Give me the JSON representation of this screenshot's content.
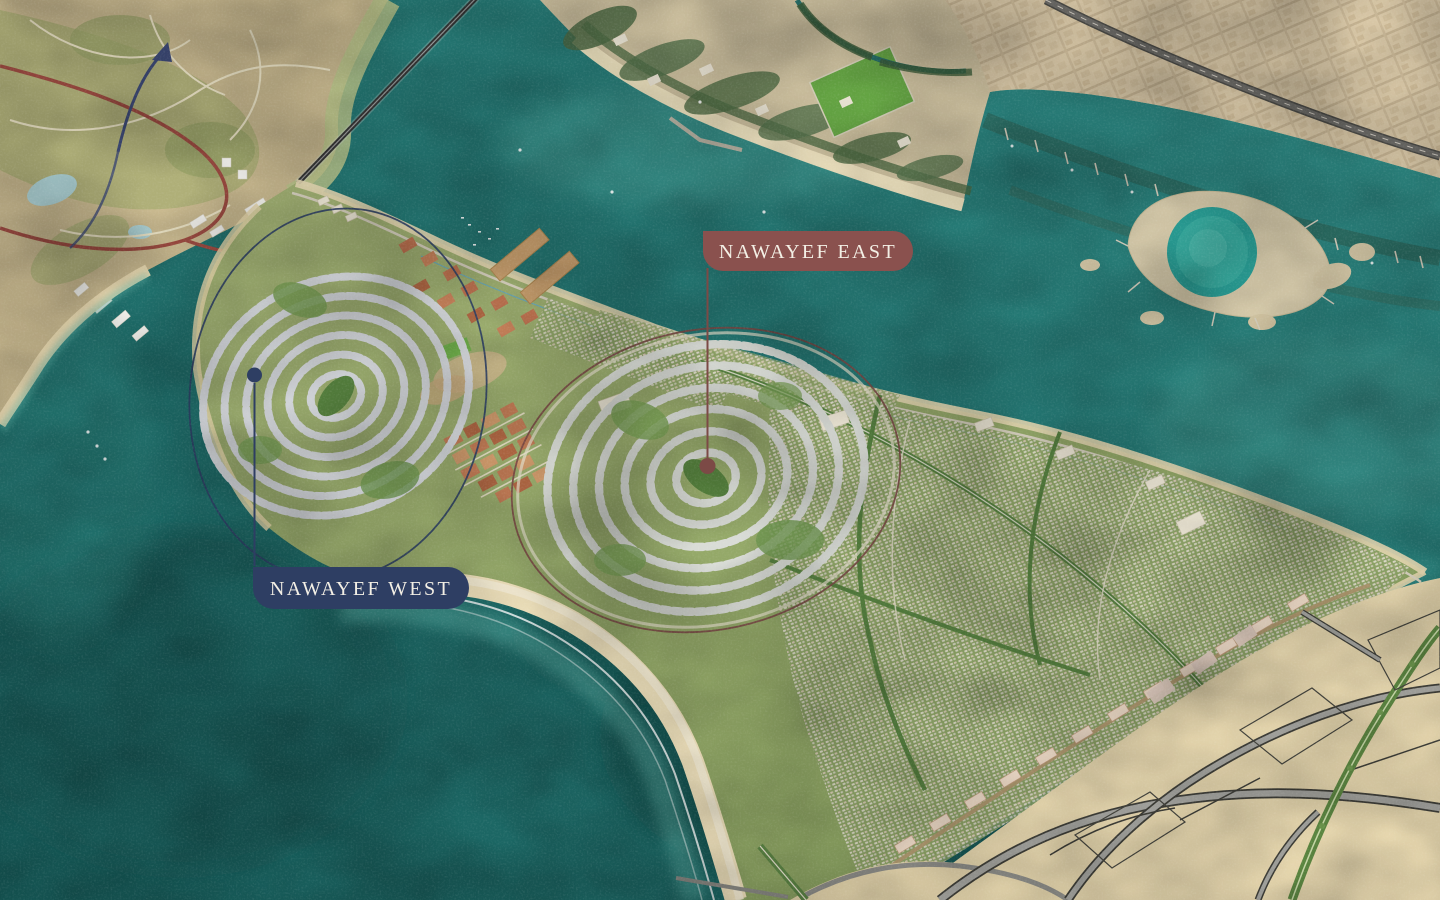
{
  "map": {
    "type": "development-masterplan-aerial",
    "labels": [
      {
        "id": "nawayef-east",
        "text": "NAWAYEF EAST",
        "badge_color": "#8A514E"
      },
      {
        "id": "nawayef-west",
        "text": "NAWAYEF WEST",
        "badge_color": "#2E3E63"
      }
    ],
    "label_text_color": "#F3EFE5"
  },
  "palette": {
    "water_deep": "#175D5B",
    "water_channel": "#2F8D87",
    "island_green": "#92A868",
    "beach_sand": "#F0E2BD",
    "city_beige": "#D8C7A6",
    "plan_tan": "#ECDCB2"
  }
}
